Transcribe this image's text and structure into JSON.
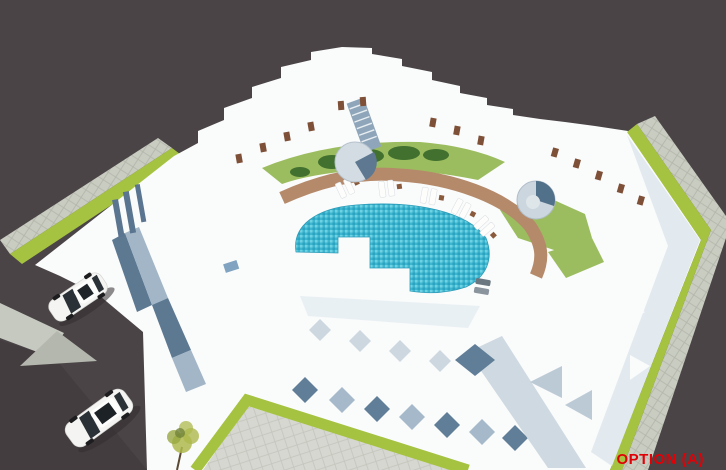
{
  "annotation": {
    "label": "OPTION (A)",
    "color": "#e20007"
  },
  "scene": {
    "type": "3d-architectural-aerial-render",
    "subject": "white stepped courtyard housing block with crescent swimming pool",
    "elements": {
      "pool": "crescent tiled swimming pool",
      "pool_deck": "curved tan pool deck path",
      "loungers": "5 pairs of white sun loungers with side tables",
      "stair_towers": "2 cylindrical stair towers",
      "lawns": "courtyard lawns with hedges",
      "vehicles": [
        "white sedan",
        "white suv"
      ],
      "streetscape": "paved sidewalks with green verge strips along dark asphalt roads",
      "tree": "small yellow-green tree at south-west corner"
    }
  },
  "colors": {
    "ground": "#4a4446",
    "asphalt_dark": "#443d3f",
    "building_white": "#fafbfb",
    "shadow_blue": "#607e97",
    "shadow_blue_light": "#a5b9ca",
    "pool_water": "#3fb6d0",
    "pool_deck": "#b58a6b",
    "lawn": "#9cbd5f",
    "hedge": "#41702f",
    "green_strip": "#a5c340",
    "sidewalk": "#c9ccc1",
    "plaza": "#d6d7d0",
    "door_brown": "#7d5037",
    "car_white": "#f4f4f2",
    "label_red": "#e20007"
  }
}
